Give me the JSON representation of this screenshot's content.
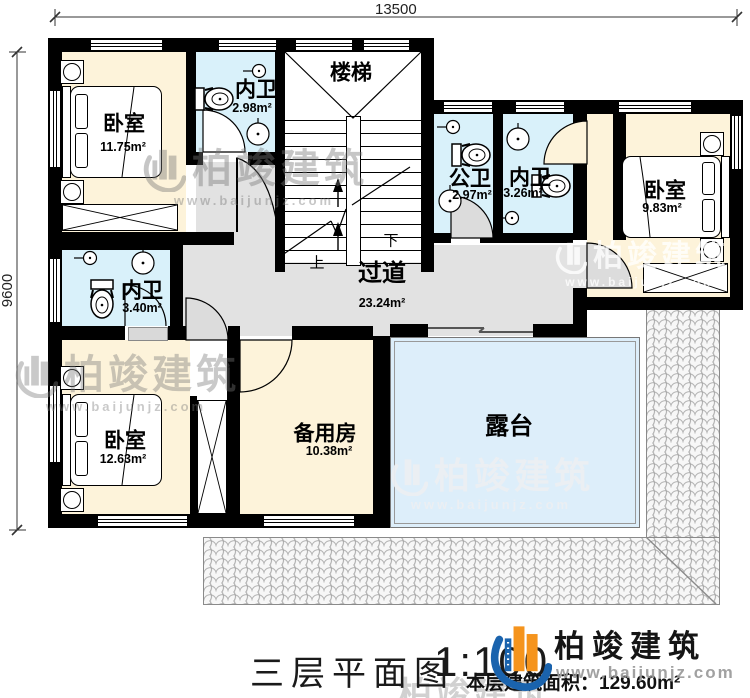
{
  "dimensions": {
    "width_label": "13500",
    "height_label": "9600"
  },
  "rooms": {
    "bedroom_tl": {
      "name": "卧室",
      "area": "11.75m²"
    },
    "bath_tl": {
      "name": "内卫",
      "area": "2.98m²"
    },
    "stairs": {
      "name": "楼梯"
    },
    "public_bath": {
      "name": "公卫",
      "area": "2.97m²"
    },
    "bath_right": {
      "name": "内卫",
      "area": "3.26m²"
    },
    "bedroom_r": {
      "name": "卧室",
      "area": "9.83m²"
    },
    "bath_left": {
      "name": "内卫",
      "area": "3.40m²"
    },
    "corridor": {
      "name": "过道",
      "area": "23.24m²"
    },
    "bedroom_bl": {
      "name": "卧室",
      "area": "12.63m²"
    },
    "spare": {
      "name": "备用房",
      "area": "10.38m²"
    },
    "terrace": {
      "name": "露台"
    }
  },
  "stair_marks": {
    "up": "上",
    "down": "下"
  },
  "footer": {
    "plan_title": "三层平面图",
    "scale": "1:100",
    "area_note": "本层建筑面积：129.60m²"
  },
  "brand": {
    "name": "柏竣建筑",
    "url": "www.baijunjz.com"
  },
  "colors": {
    "wall": "#000000",
    "bedroom_fill": "#fdf3da",
    "bath_fill": "#d9f1fa",
    "terrace_fill": "#ddeefa",
    "corridor_fill": "#e2e2e2",
    "brand_blue": "#1a63ad",
    "brand_orange": "#f5941d"
  }
}
